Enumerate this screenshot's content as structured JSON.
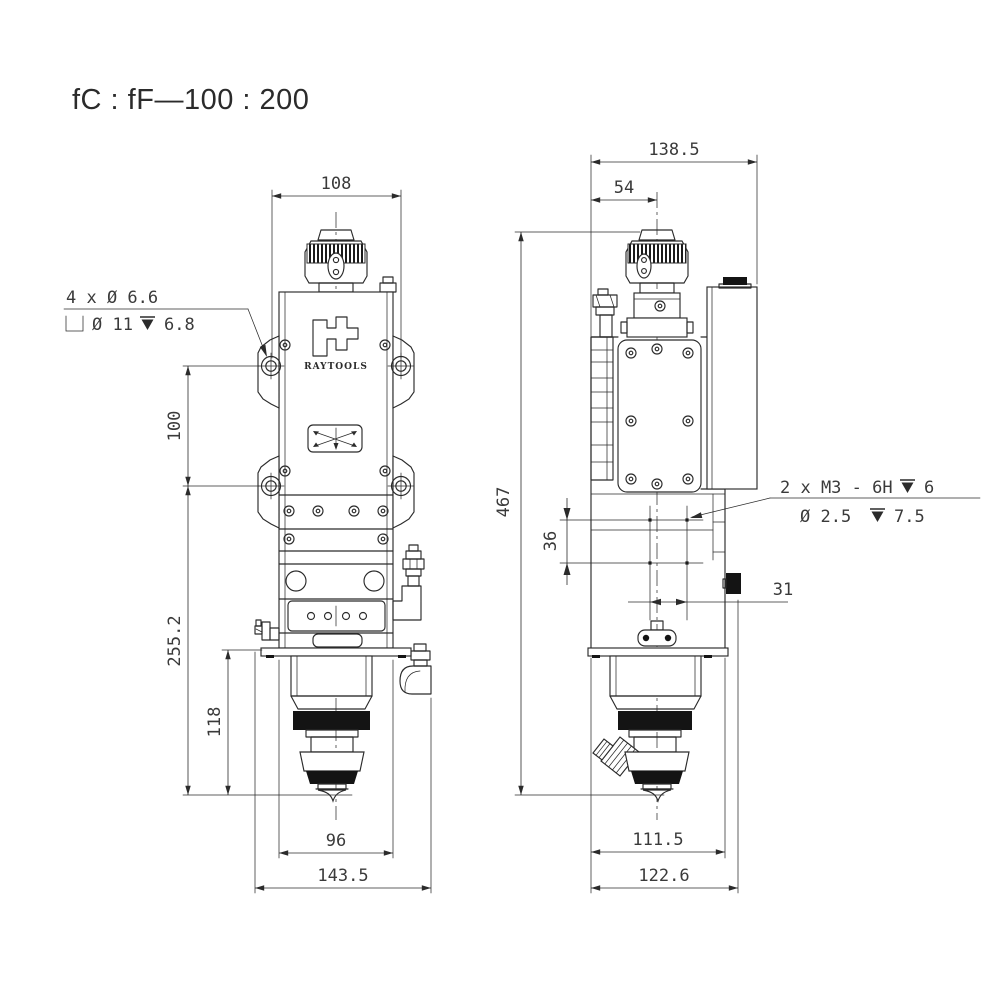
{
  "title": "fC : fF—100 : 200",
  "brand": {
    "name": "RAYTOOLS"
  },
  "front_view": {
    "dims": {
      "top_width": "108",
      "mount_hole_spacing": "100",
      "mount_to_tip": "255.2",
      "lower_section_height": "118",
      "body_width": "96",
      "overall_width": "143.5"
    },
    "counterbore_note": {
      "line1": "4 x Ø 6.6",
      "bore_dia": "Ø 11",
      "bore_depth": "6.8"
    }
  },
  "side_view": {
    "dims": {
      "overall_depth": "138.5",
      "lens_center_offset": "54",
      "overall_height": "467",
      "hole_spacing_vertical": "36",
      "hole_spacing_horizontal": "31",
      "body_depth": "111.5",
      "overall_depth_bottom": "122.6"
    },
    "thread_note": {
      "line1": "2 x M3 - 6H",
      "depth1": "6",
      "dia": "Ø 2.5",
      "depth2": "7.5"
    }
  }
}
